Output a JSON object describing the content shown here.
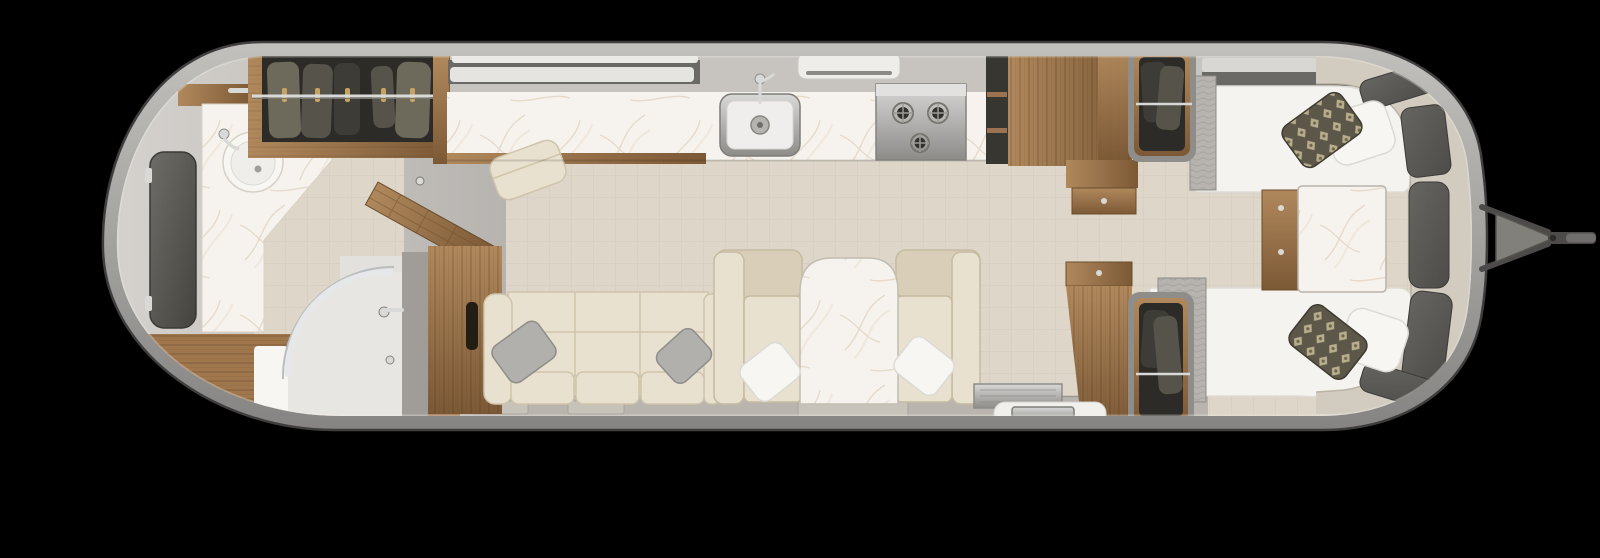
{
  "scene": {
    "width": 1600,
    "height": 558
  },
  "colors": {
    "bg": "#000000",
    "shellLight": "#c2c0bd",
    "shellMid": "#a5a3a0",
    "shellDark": "#868482",
    "shellEdge": "#3f3e3c",
    "wall": "#d6d3cf",
    "wallShade": "#b7b4b0",
    "floor": "#ddd6c9",
    "floorLine": "#bfb4a0",
    "walkway": "#b9b5ae",
    "mat": "#c8c3ba",
    "woodHi": "#b0885c",
    "woodLo": "#7c5936",
    "woodFloor": "#a0764c",
    "marbleBase": "#f6f3ee",
    "marbleVein": "#d8c5af",
    "white": "#f7f6f3",
    "mattress": "#f4f3ef",
    "cream": "#e9e1cf",
    "creamShade": "#d9cfb8",
    "creamLine": "#c6bba2",
    "bandCream": "#d2cbbf",
    "runner": "#b7b4af",
    "runnerLine": "#96938d",
    "pillowGray": "#b2b0ad",
    "accentDark": "#5c5749",
    "accentLight": "#c2b795",
    "darkInterior": "#2d2b27",
    "cloth1": "#56534a",
    "cloth2": "#3d3c37",
    "cloth3": "#6e6a5b",
    "chrome": "#d9d9d7",
    "chromeDark": "#8f8f8d",
    "steelHi": "#d8d8d6",
    "steelLo": "#8d8c89",
    "windowDark": "#4e4c49",
    "stepWhite": "#f1f0ed",
    "grayStrip": "#a09d99",
    "darkShelf": "#6b6965",
    "silverBar": "#d9d7d3",
    "burner": "#32312d",
    "hitch": "#82807b",
    "hitchDark": "#4c4b49",
    "showerFloor": "#e8e6e3",
    "showerWall": "#e3e1dd"
  }
}
